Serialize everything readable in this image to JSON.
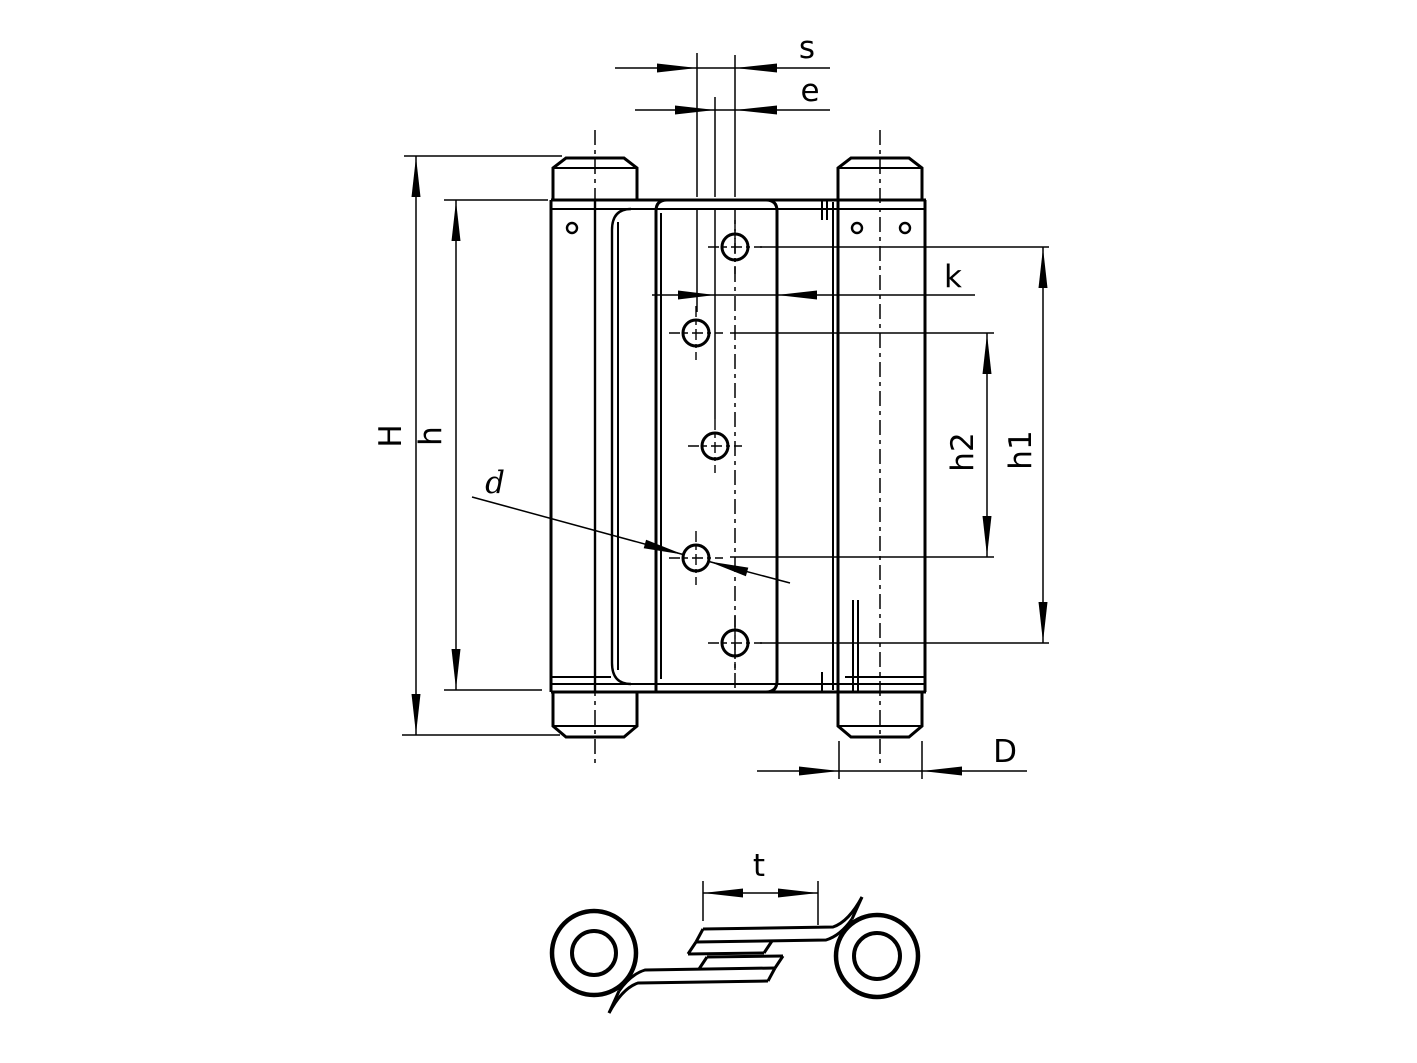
{
  "drawing": {
    "type": "technical-dimension-drawing",
    "views": {
      "front_view": "double-action spring hinge, front elevation",
      "section_view": "horizontal cross-section through hinge leaves"
    },
    "colors": {
      "line": "#000000",
      "background": "#ffffff"
    },
    "labels": {
      "s": "s",
      "e": "e",
      "k": "k",
      "H": "H",
      "h": "h",
      "d": "d",
      "h2": "h2",
      "h1": "h1",
      "D": "D",
      "t": "t"
    }
  }
}
